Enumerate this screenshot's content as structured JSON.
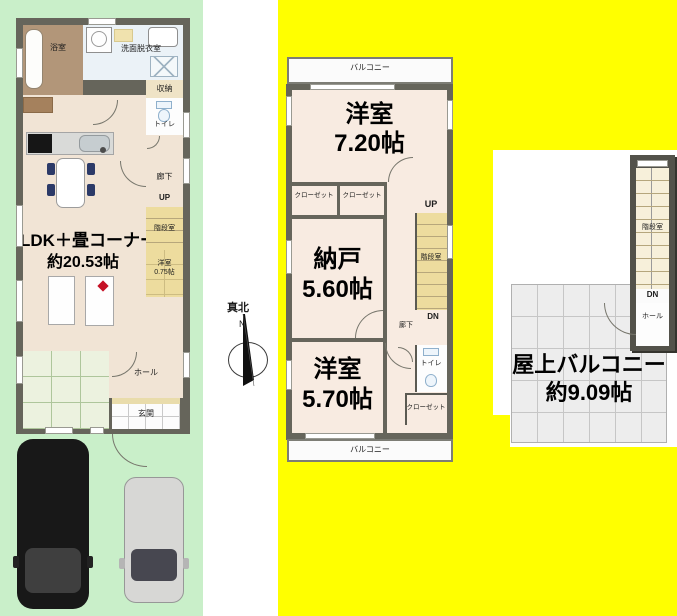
{
  "floor1": {
    "bath_label": "浴室",
    "washroom_label": "洗面脱衣室",
    "storage_label": "収納",
    "toilet_label": "トイレ",
    "corridor_label": "廊下",
    "up_label": "UP",
    "stairwell_label": "階段室",
    "small_room_name": "洋室",
    "small_room_size": "0.75帖",
    "ldk_name": "LDK＋畳コーナー",
    "ldk_size": "約20.53帖",
    "hall_label": "ホール",
    "entrance_label": "玄関"
  },
  "floor2": {
    "balcony_top_label": "バルコニー",
    "room1_name": "洋室",
    "room1_size": "7.20帖",
    "closet_left_label": "クローゼット",
    "closet_right_label": "クローゼット",
    "up_label": "UP",
    "stairwell_label": "階段室",
    "dn_label": "DN",
    "corridor_label": "廊下",
    "storage_room_name": "納戸",
    "storage_room_size": "5.60帖",
    "toilet_label": "トイレ",
    "closet_bottom_label": "クローゼット",
    "room2_name": "洋室",
    "room2_size": "5.70帖",
    "balcony_bottom_label": "バルコニー"
  },
  "roof": {
    "stairwell_label": "階段室",
    "dn_label": "DN",
    "hall_label": "ホール",
    "balcony_name": "屋上バルコニー",
    "balcony_size": "約9.09帖"
  },
  "compass": {
    "title": "真北",
    "north": "N"
  },
  "colors": {
    "site_green": "#c9efc9",
    "highlight_yellow": "#ffff00",
    "wall_gray": "#66655b",
    "floor1_beige": "#f1e4d5",
    "floor2_pink": "#f8ebe1",
    "stairs_tan": "#eddc9e",
    "tatami_green": "#ecf2df",
    "bath_brown": "#b29679",
    "roof_grid_gray": "#ededed",
    "marker_red": "#c51126"
  }
}
